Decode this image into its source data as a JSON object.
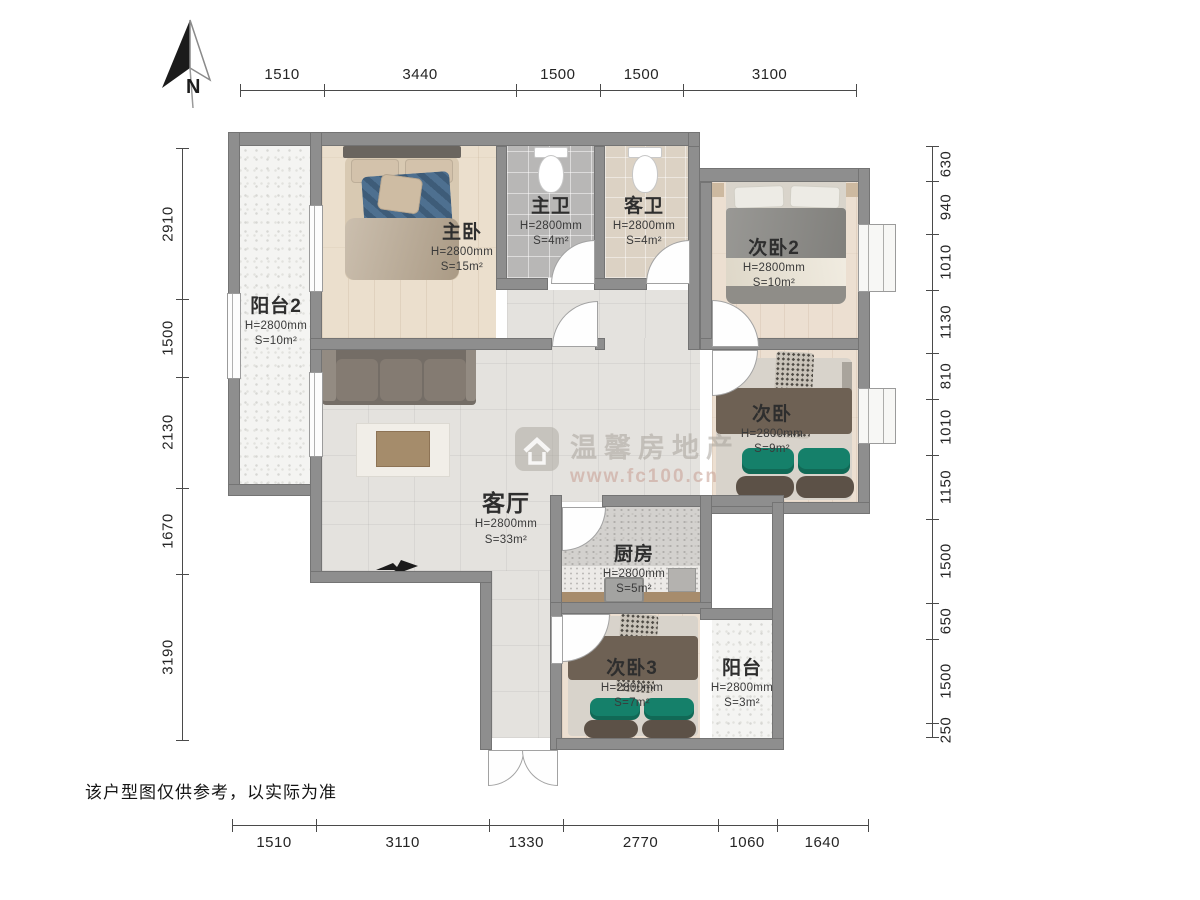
{
  "compass": {
    "label": "N"
  },
  "watermark": {
    "brand": "温馨房地产",
    "url": "www.fc100.cn"
  },
  "disclaimer": "该户型图仅供参考，以实际为准",
  "rooms": {
    "master": {
      "name": "主卧",
      "height": "H=2800mm",
      "area": "S=15m²"
    },
    "bath_master": {
      "name": "主卫",
      "height": "H=2800mm",
      "area": "S=4m²"
    },
    "bath_guest": {
      "name": "客卫",
      "height": "H=2800mm",
      "area": "S=4m²"
    },
    "bedroom2": {
      "name": "次卧2",
      "height": "H=2800mm",
      "area": "S=10m²"
    },
    "bedroom": {
      "name": "次卧",
      "height": "H=2800mm",
      "area": "S=9m²"
    },
    "bedroom3": {
      "name": "次卧3",
      "height": "H=2800mm",
      "area": "S=7m²"
    },
    "living": {
      "name": "客厅",
      "height": "H=2800mm",
      "area": "S=33m²"
    },
    "kitchen": {
      "name": "厨房",
      "height": "H=2800mm",
      "area": "S=5m²"
    },
    "balcony2": {
      "name": "阳台2",
      "height": "H=2800mm",
      "area": "S=10m²"
    },
    "balcony": {
      "name": "阳台",
      "height": "H=2800mm",
      "area": "S=3m²"
    }
  },
  "dimensions": {
    "top": [
      1510,
      3440,
      1500,
      1500,
      3100
    ],
    "bottom": [
      1510,
      3110,
      1330,
      2770,
      1060,
      1640
    ],
    "left": [
      2910,
      1500,
      2130,
      1670,
      3190
    ],
    "right": [
      630,
      940,
      1010,
      1130,
      810,
      1010,
      1150,
      1500,
      650,
      1500,
      250
    ]
  },
  "colors": {
    "wall": "#8e8e8e",
    "accent_teal": "#15806a",
    "duvet_brown": "#6e6154"
  }
}
